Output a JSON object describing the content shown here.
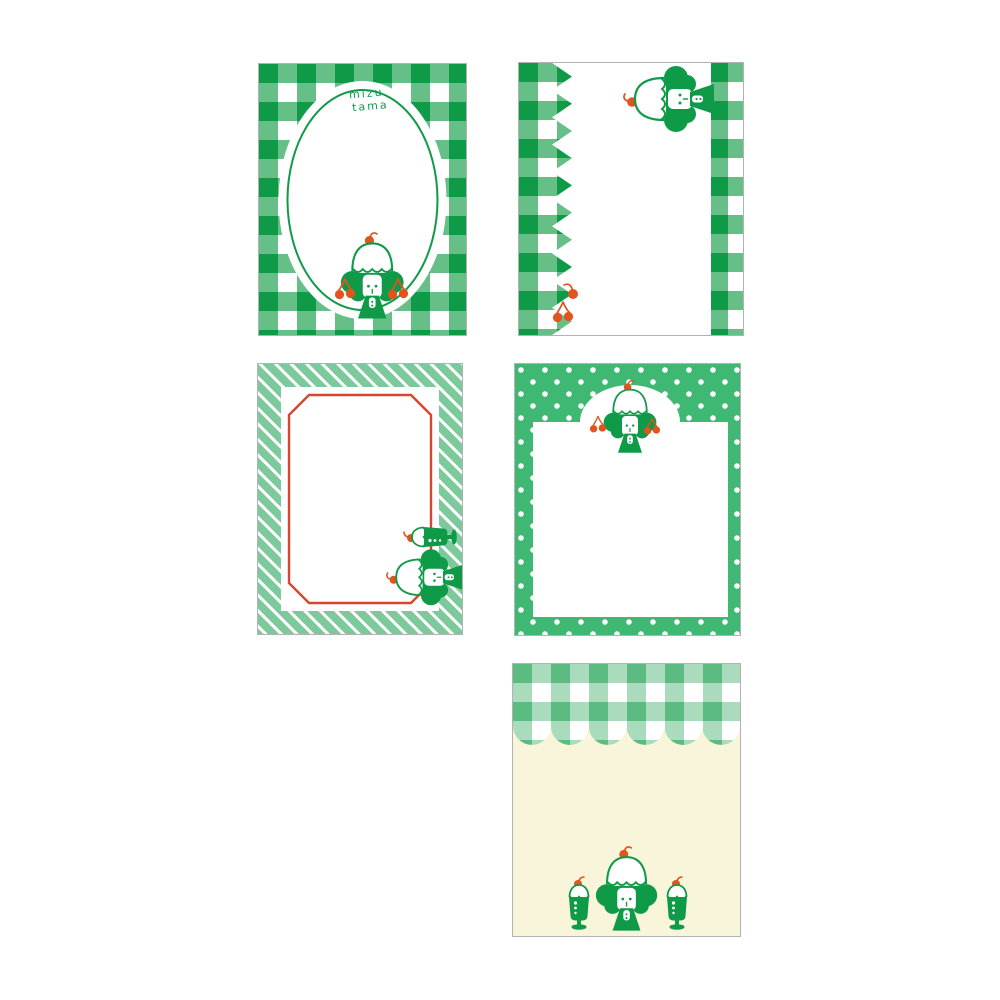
{
  "page": {
    "background": "#ffffff"
  },
  "brand": {
    "line1": "mizu",
    "line2": "tama"
  },
  "colors": {
    "pageBg": "#ffffff",
    "greenDark": "#0f9a48",
    "greenMid": "#66bf86",
    "mint": "#7cc99b",
    "polka": "#3eb873",
    "sageDark": "#5cbb81",
    "sageMid": "#aadbbc",
    "cream": "#f8f5db",
    "frameRed": "#d5472e",
    "cherryRed": "#e2531e",
    "cardEdge": "rgba(0,0,0,0.30)"
  },
  "cards": [
    {
      "name": "gingham-oval",
      "pattern": "green gingham check",
      "frame": "white oval with green inner outline",
      "label": "mizu tama",
      "motifs": [
        "pudding-girl",
        "cherry-pair",
        "cherry-pair"
      ]
    },
    {
      "name": "gingham-zigzag",
      "pattern": "green gingham side bands, zigzag left edge",
      "motifs": [
        "pudding-girl-sideways",
        "cherry",
        "cherry-pair"
      ]
    },
    {
      "name": "stripes-red-frame",
      "pattern": "mint diagonal stripes",
      "frame": "red octagonal rule",
      "motifs": [
        "cream-soda-sideways",
        "pudding-girl-sideways"
      ]
    },
    {
      "name": "polka-dot-arch",
      "pattern": "green polka dots",
      "frame": "white panel with arch top",
      "motifs": [
        "pudding-girl",
        "cherry-pair",
        "cherry-pair"
      ]
    },
    {
      "name": "gingham-awning-cream",
      "pattern": "sage gingham scalloped awning over cream",
      "motifs": [
        "cream-soda",
        "pudding-girl",
        "cream-soda"
      ]
    }
  ]
}
